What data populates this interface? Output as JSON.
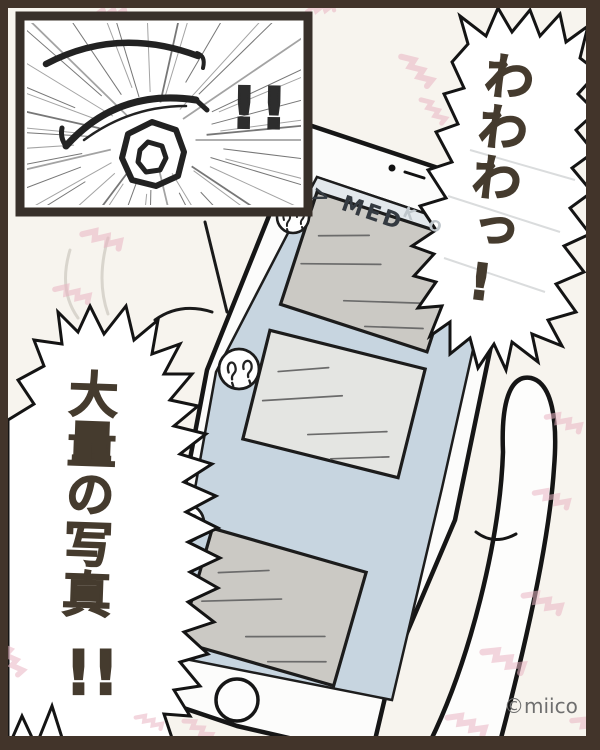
{
  "inset_panel": {
    "exclamation": "!!"
  },
  "phone": {
    "header": {
      "visible_text": "> MED",
      "faded_letters": "KO"
    },
    "photo_count": 3
  },
  "speech_bubbles": {
    "right": {
      "text": "わわわっ!"
    },
    "left": {
      "text": "大量の写真",
      "exclamation": "!!"
    }
  },
  "credit": "©miico",
  "colors": {
    "frame_brown": "#42342a",
    "screen_blue": "#c7d5e0",
    "header_band": "#e3e8ec",
    "card_gray": "#cbc9c4",
    "card_light_gray": "#e4e5e2",
    "pink_accent": "#eab4c2",
    "ink": "#1a1a1a",
    "speech_ink": "#453b2e",
    "credit_gray": "#6f6f6f"
  }
}
